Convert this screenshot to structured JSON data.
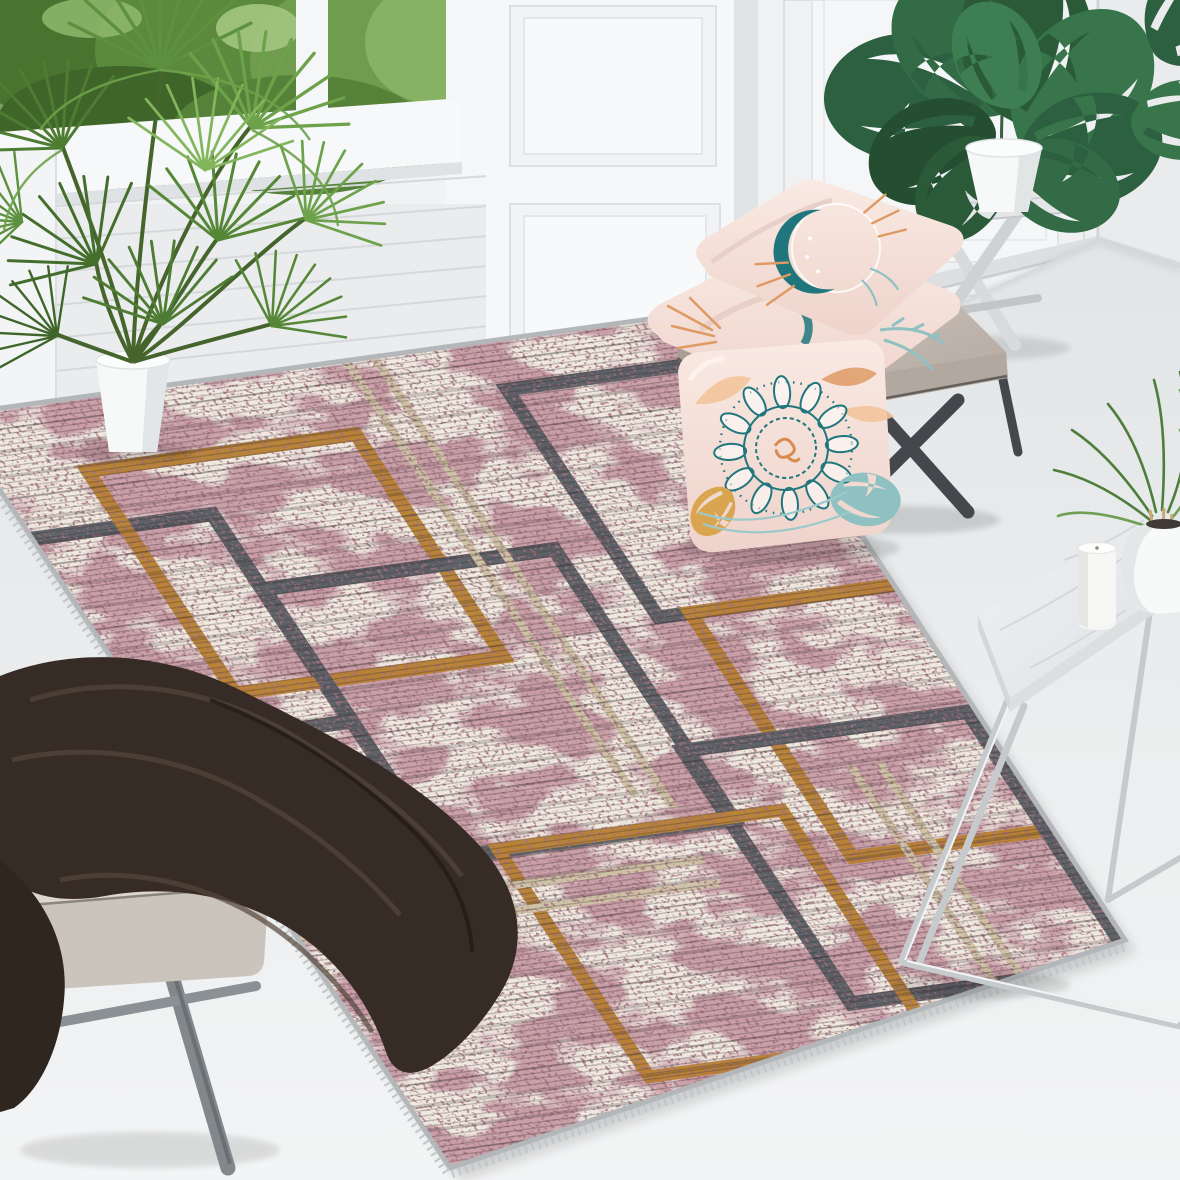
{
  "scene": {
    "type": "interior product photograph",
    "subject": "distressed geometric area rug styled in a bright white living room",
    "objects": [
      "area rug with maroon distressed texture and gray, gold and beige rectangle frames",
      "fan palm in white pot",
      "window with garden greenery",
      "white shiplap wall",
      "raised panel wall and pillar",
      "monstera plant in white pot",
      "whitewashed folding plant stand",
      "gray ottoman bench with x legs",
      "two stacked pink boho print pillows",
      "leaning pink mandala pillow",
      "dark brown throw blanket",
      "beige cushioned stool",
      "marble side table with chrome legs",
      "white pillar candle",
      "white round vase with small palm"
    ]
  },
  "palette": {
    "wall": "#f0f2f3",
    "wallShade": "#e1e4e7",
    "floorTop": "#e2e5e7",
    "floorBottom": "#f3f4f5",
    "rugCream": "#f0e9e0",
    "rugMaroon": "#8b4a59",
    "rugMaroonDark": "#5f2a36",
    "rugGray": "#565c62",
    "rugGold": "#b8802f",
    "rugBeige": "#cfc3a6",
    "rugEdge": "#b3b7ba",
    "benchTaupe": "#c4bab2",
    "benchLeg": "#44484c",
    "pillowPink": "#f7e4dd",
    "pillowTeal": "#20767d",
    "pillowTealLight": "#8fc0c2",
    "pillowOrange": "#df9a64",
    "blanketBrown": "#372c25",
    "stoolBeige": "#ddd6ce",
    "woodGray": "#82878c",
    "marble": "#e9ecee",
    "chrome": "#c6cacd",
    "candleWhite": "#f6f6f4",
    "potWhite": "#f7f8f8",
    "leafDark": "#2d6040",
    "leafMid": "#38754a",
    "leafLight": "#6da24a",
    "palmGreen": "#5d9140",
    "windowGreen": "#5c8a3c"
  }
}
